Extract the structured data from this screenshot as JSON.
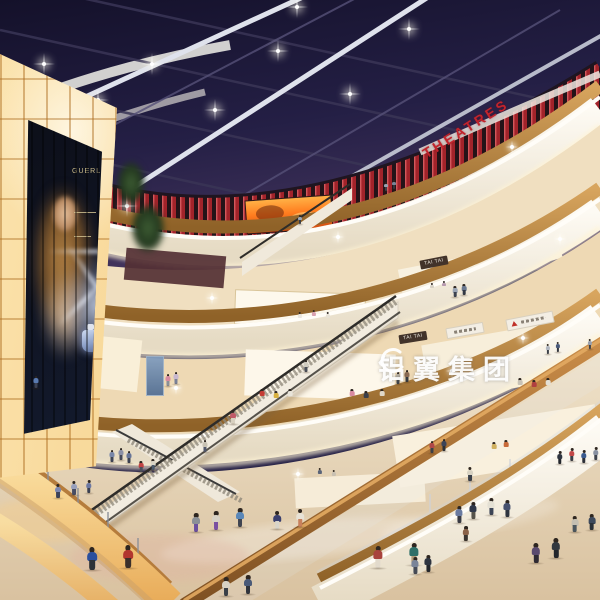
{
  "scene": {
    "description": "Photorealistic rendering of a multi-level shopping mall atrium at night: glass skylight ceiling, red cinema level, curved cream balconies, escalators, glowing amber panel wall with perfume billboard, shoppers on polished floors",
    "watermark": {
      "text": "铝翼集团",
      "logo": "swoosh-mark"
    },
    "signs": {
      "theatres": "THEATRES",
      "tai_tai_upper": "TAI TAI",
      "tai_tai_lower": "TAI TAI"
    },
    "billboard": {
      "brand": "GUERLAIN"
    },
    "colors": {
      "sky": "#241f45",
      "theatre_red": "#a6232a",
      "sign_red": "#c2242c",
      "wood": "#b5793c",
      "panel_amber": "#f5c87e",
      "cream_fascia": "#f6f1e8",
      "floor": "#e4d4b8",
      "screen_orange": "#ff7d1f"
    },
    "ceiling_lights": [
      [
        44,
        64
      ],
      [
        98,
        100
      ],
      [
        152,
        64
      ],
      [
        215,
        110
      ],
      [
        278,
        51
      ],
      [
        350,
        94
      ],
      [
        409,
        29
      ],
      [
        57,
        170
      ],
      [
        127,
        206
      ],
      [
        297,
        7
      ]
    ],
    "sparkles": [
      [
        212,
        298
      ],
      [
        338,
        237
      ],
      [
        512,
        147
      ],
      [
        523,
        338
      ],
      [
        452,
        371
      ],
      [
        176,
        388
      ],
      [
        298,
        474
      ],
      [
        560,
        239
      ]
    ],
    "people": [
      [
        92,
        570,
        23,
        "#2b4f9e",
        "#2e3138"
      ],
      [
        128,
        568,
        23,
        "#b2362e",
        "#3a2f2a"
      ],
      [
        196,
        532,
        19,
        "#8a8f96",
        "#6a4f9e"
      ],
      [
        216,
        530,
        19,
        "#d8d2c6",
        "#7a50a2"
      ],
      [
        240,
        527,
        19,
        "#5a87b8",
        "#3f4450"
      ],
      [
        277,
        529,
        18,
        "#3a3f6e",
        "#d8d4ca"
      ],
      [
        300,
        527,
        18,
        "#e8e2d6",
        "#c8805c"
      ],
      [
        378,
        568,
        22,
        "#a8433c",
        "#e2dacc"
      ],
      [
        414,
        565,
        22,
        "#2e6f68",
        "#b09a78"
      ],
      [
        459,
        523,
        17,
        "#6a7aa0",
        "#383a44"
      ],
      [
        473,
        519,
        17,
        "#30384a",
        "#55524a"
      ],
      [
        491,
        515,
        17,
        "#e4e0d4",
        "#3c4456"
      ],
      [
        507,
        517,
        17,
        "#46506e",
        "#2e3440"
      ],
      [
        466,
        541,
        15,
        "#8a6248",
        "#3a3530"
      ],
      [
        536,
        563,
        20,
        "#5a4a6e",
        "#2f2a33"
      ],
      [
        556,
        558,
        20,
        "#32383f",
        "#23262b"
      ],
      [
        575,
        532,
        16,
        "#c4bfb2",
        "#4a565e"
      ],
      [
        592,
        530,
        16,
        "#3e4a5c",
        "#2b3138"
      ],
      [
        226,
        596,
        19,
        "#d8d2c4",
        "#3a4048"
      ],
      [
        248,
        594,
        19,
        "#4a5a78",
        "#30343c"
      ],
      [
        415,
        574,
        17,
        "#7a8498",
        "#454a56"
      ],
      [
        428,
        572,
        17,
        "#2e3440",
        "#23262c"
      ],
      [
        58,
        498,
        14,
        "#7a86b0",
        "#3c4258"
      ],
      [
        74,
        495,
        14,
        "#98a0bc",
        "#474d64"
      ],
      [
        89,
        493,
        13,
        "#6c78a2",
        "#3a4052"
      ],
      [
        112,
        462,
        12,
        "#7886a8",
        "#3e4456"
      ],
      [
        121,
        460,
        12,
        "#8a8fa6",
        "#44485a"
      ],
      [
        129,
        463,
        12,
        "#667498",
        "#3a4050"
      ],
      [
        141,
        472,
        11,
        "#c04444",
        "#4a4e5a"
      ],
      [
        153,
        470,
        11,
        "#d8d4c6",
        "#4a5a6c"
      ],
      [
        205,
        452,
        12,
        "#c8c2b4",
        "#50566a"
      ],
      [
        233,
        424,
        14,
        "#c05a68",
        "#d8d0c0"
      ],
      [
        306,
        372,
        12,
        "#d0ccc0",
        "#4a4e58"
      ],
      [
        168,
        386,
        12,
        "#d88aa0",
        "#8a8f98"
      ],
      [
        176,
        384,
        12,
        "#c8b8d0",
        "#7a8096"
      ],
      [
        36,
        388,
        12,
        "#5a7ab0",
        "#3c4254"
      ],
      [
        398,
        384,
        12,
        "#b8b2a6",
        "#3e4248"
      ],
      [
        407,
        382,
        12,
        "#8a6a52",
        "#34383e"
      ],
      [
        455,
        297,
        11,
        "#9aa4b4",
        "#3c4250"
      ],
      [
        464,
        295,
        11,
        "#6a7890",
        "#333944"
      ],
      [
        386,
        191,
        9,
        "#9aa2b0",
        "#3a3f48"
      ],
      [
        394,
        189,
        9,
        "#7a8496",
        "#30343c"
      ],
      [
        300,
        224,
        9,
        "#9aa4b2",
        "#3a3e46"
      ],
      [
        470,
        481,
        14,
        "#d8d2c2",
        "#3a3f48"
      ],
      [
        432,
        453,
        12,
        "#b04848",
        "#3c4048"
      ],
      [
        444,
        451,
        12,
        "#3c4458",
        "#2b2f36"
      ],
      [
        560,
        464,
        13,
        "#2f3540",
        "#23262c"
      ],
      [
        572,
        461,
        13,
        "#c24848",
        "#3a3e46"
      ],
      [
        584,
        463,
        13,
        "#3a5a8e",
        "#2c3038"
      ],
      [
        596,
        460,
        13,
        "#8890a0",
        "#3f434c"
      ],
      [
        548,
        354,
        10,
        "#b0b6c0",
        "#3c4048"
      ],
      [
        558,
        352,
        10,
        "#4a5a7a",
        "#30343c"
      ],
      [
        590,
        349,
        10,
        "#9aa0ac",
        "#3c404a"
      ]
    ],
    "mannequins": [
      [
        262,
        400,
        11,
        "#c43c34"
      ],
      [
        276,
        402,
        11,
        "#d8b040"
      ],
      [
        290,
        400,
        11,
        "#e8e4da"
      ],
      [
        352,
        400,
        11,
        "#d88aa0"
      ],
      [
        366,
        402,
        11,
        "#3a3e48"
      ],
      [
        382,
        400,
        11,
        "#e0d8c8"
      ],
      [
        300,
        322,
        10,
        "#eae6de"
      ],
      [
        314,
        320,
        10,
        "#d8a0b0"
      ],
      [
        328,
        322,
        10,
        "#e8e2d6"
      ],
      [
        520,
        389,
        11,
        "#c8c2b6"
      ],
      [
        534,
        391,
        11,
        "#b04040"
      ],
      [
        548,
        389,
        11,
        "#e4e0d6"
      ],
      [
        494,
        453,
        11,
        "#d0b060"
      ],
      [
        506,
        451,
        11,
        "#c86a3a"
      ],
      [
        320,
        478,
        10,
        "#5a6478"
      ],
      [
        334,
        480,
        10,
        "#c8c0b2"
      ],
      [
        432,
        292,
        9,
        "#d8d2c6"
      ],
      [
        444,
        290,
        9,
        "#b89ab0"
      ]
    ]
  }
}
